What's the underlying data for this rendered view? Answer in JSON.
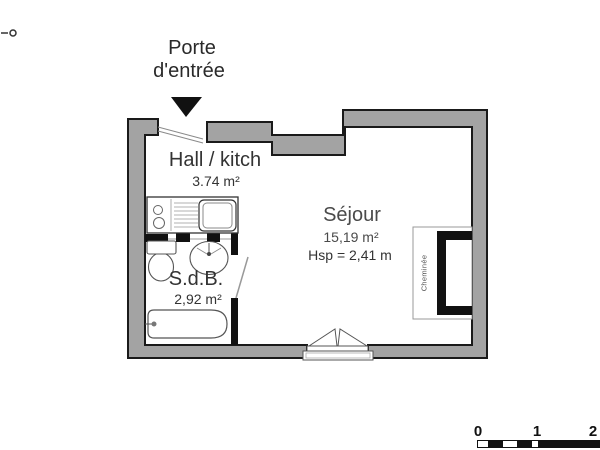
{
  "meta": {
    "type": "apartment floor plan",
    "corner_mark_icon": "dash-circle"
  },
  "entrance": {
    "label_line1": "Porte",
    "label_line2": "d'entrée",
    "arrow_icon": "down-arrow"
  },
  "rooms": [
    {
      "name": "Hall / kitch",
      "area": "3.74 m²"
    },
    {
      "name": "Séjour",
      "area": "15,19 m²",
      "height": "Hsp = 2,41 m"
    },
    {
      "name": "S.d.B.",
      "area": "2,92 m²"
    }
  ],
  "fireplace": {
    "label": "Cheminée"
  },
  "fixtures": [
    "kitchen-counter",
    "cooktop-burners",
    "drainer",
    "kitchen-sink",
    "toilet",
    "washbasin",
    "bathtub",
    "bathtub-tap",
    "entrance-door-swing",
    "bathroom-door-swing",
    "french-door",
    "fireplace"
  ],
  "scale_bar": {
    "ticks": [
      "0",
      "1",
      "2"
    ]
  },
  "colors": {
    "wall_fill": "#a3a3a3",
    "outline": "#1a1a1a",
    "fixture_stroke": "#555555",
    "text": "#333333",
    "background": "#ffffff"
  }
}
